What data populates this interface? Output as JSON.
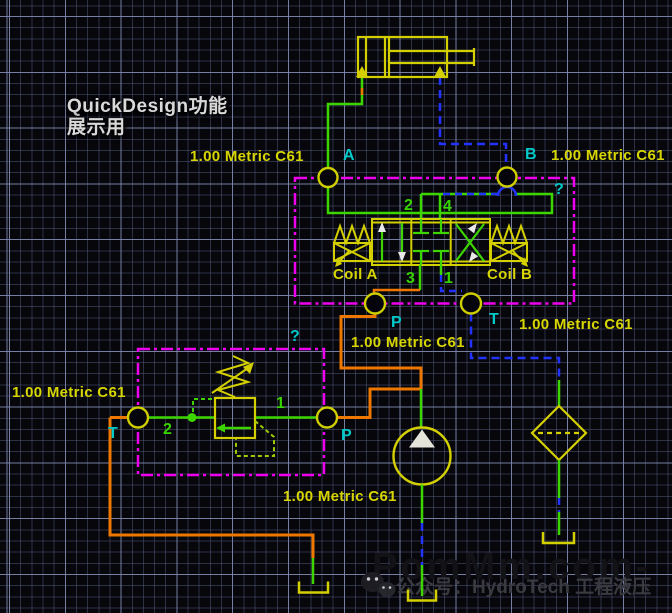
{
  "title": {
    "line1": "QuickDesign功能",
    "line2": "展示用"
  },
  "annotations": {
    "size_label": "1.00 Metric C61",
    "unknown_marker": "?"
  },
  "ports": {
    "a": "A",
    "b": "B",
    "p": "P",
    "t": "T"
  },
  "dcv": {
    "coil_a": "Coil A",
    "coil_b": "Coil B",
    "port_top_left": "2",
    "port_top_right": "4",
    "port_bottom_left": "3",
    "port_bottom_right": "1"
  },
  "relief": {
    "port_left": "2",
    "port_right": "1"
  },
  "watermark": {
    "site": "PomMm.com-",
    "wechat_line": "公众号：HydroTech 工程液压"
  },
  "colors": {
    "component_yellow": "#d4d000",
    "flow_green": "#3dd500",
    "supply_orange": "#ee7700",
    "pilot_blue": "#2233ff",
    "boundary_magenta": "#ee00ee",
    "port_cyan": "#00c9c9",
    "grid_line": "#5c688a",
    "background": "#06060b"
  }
}
